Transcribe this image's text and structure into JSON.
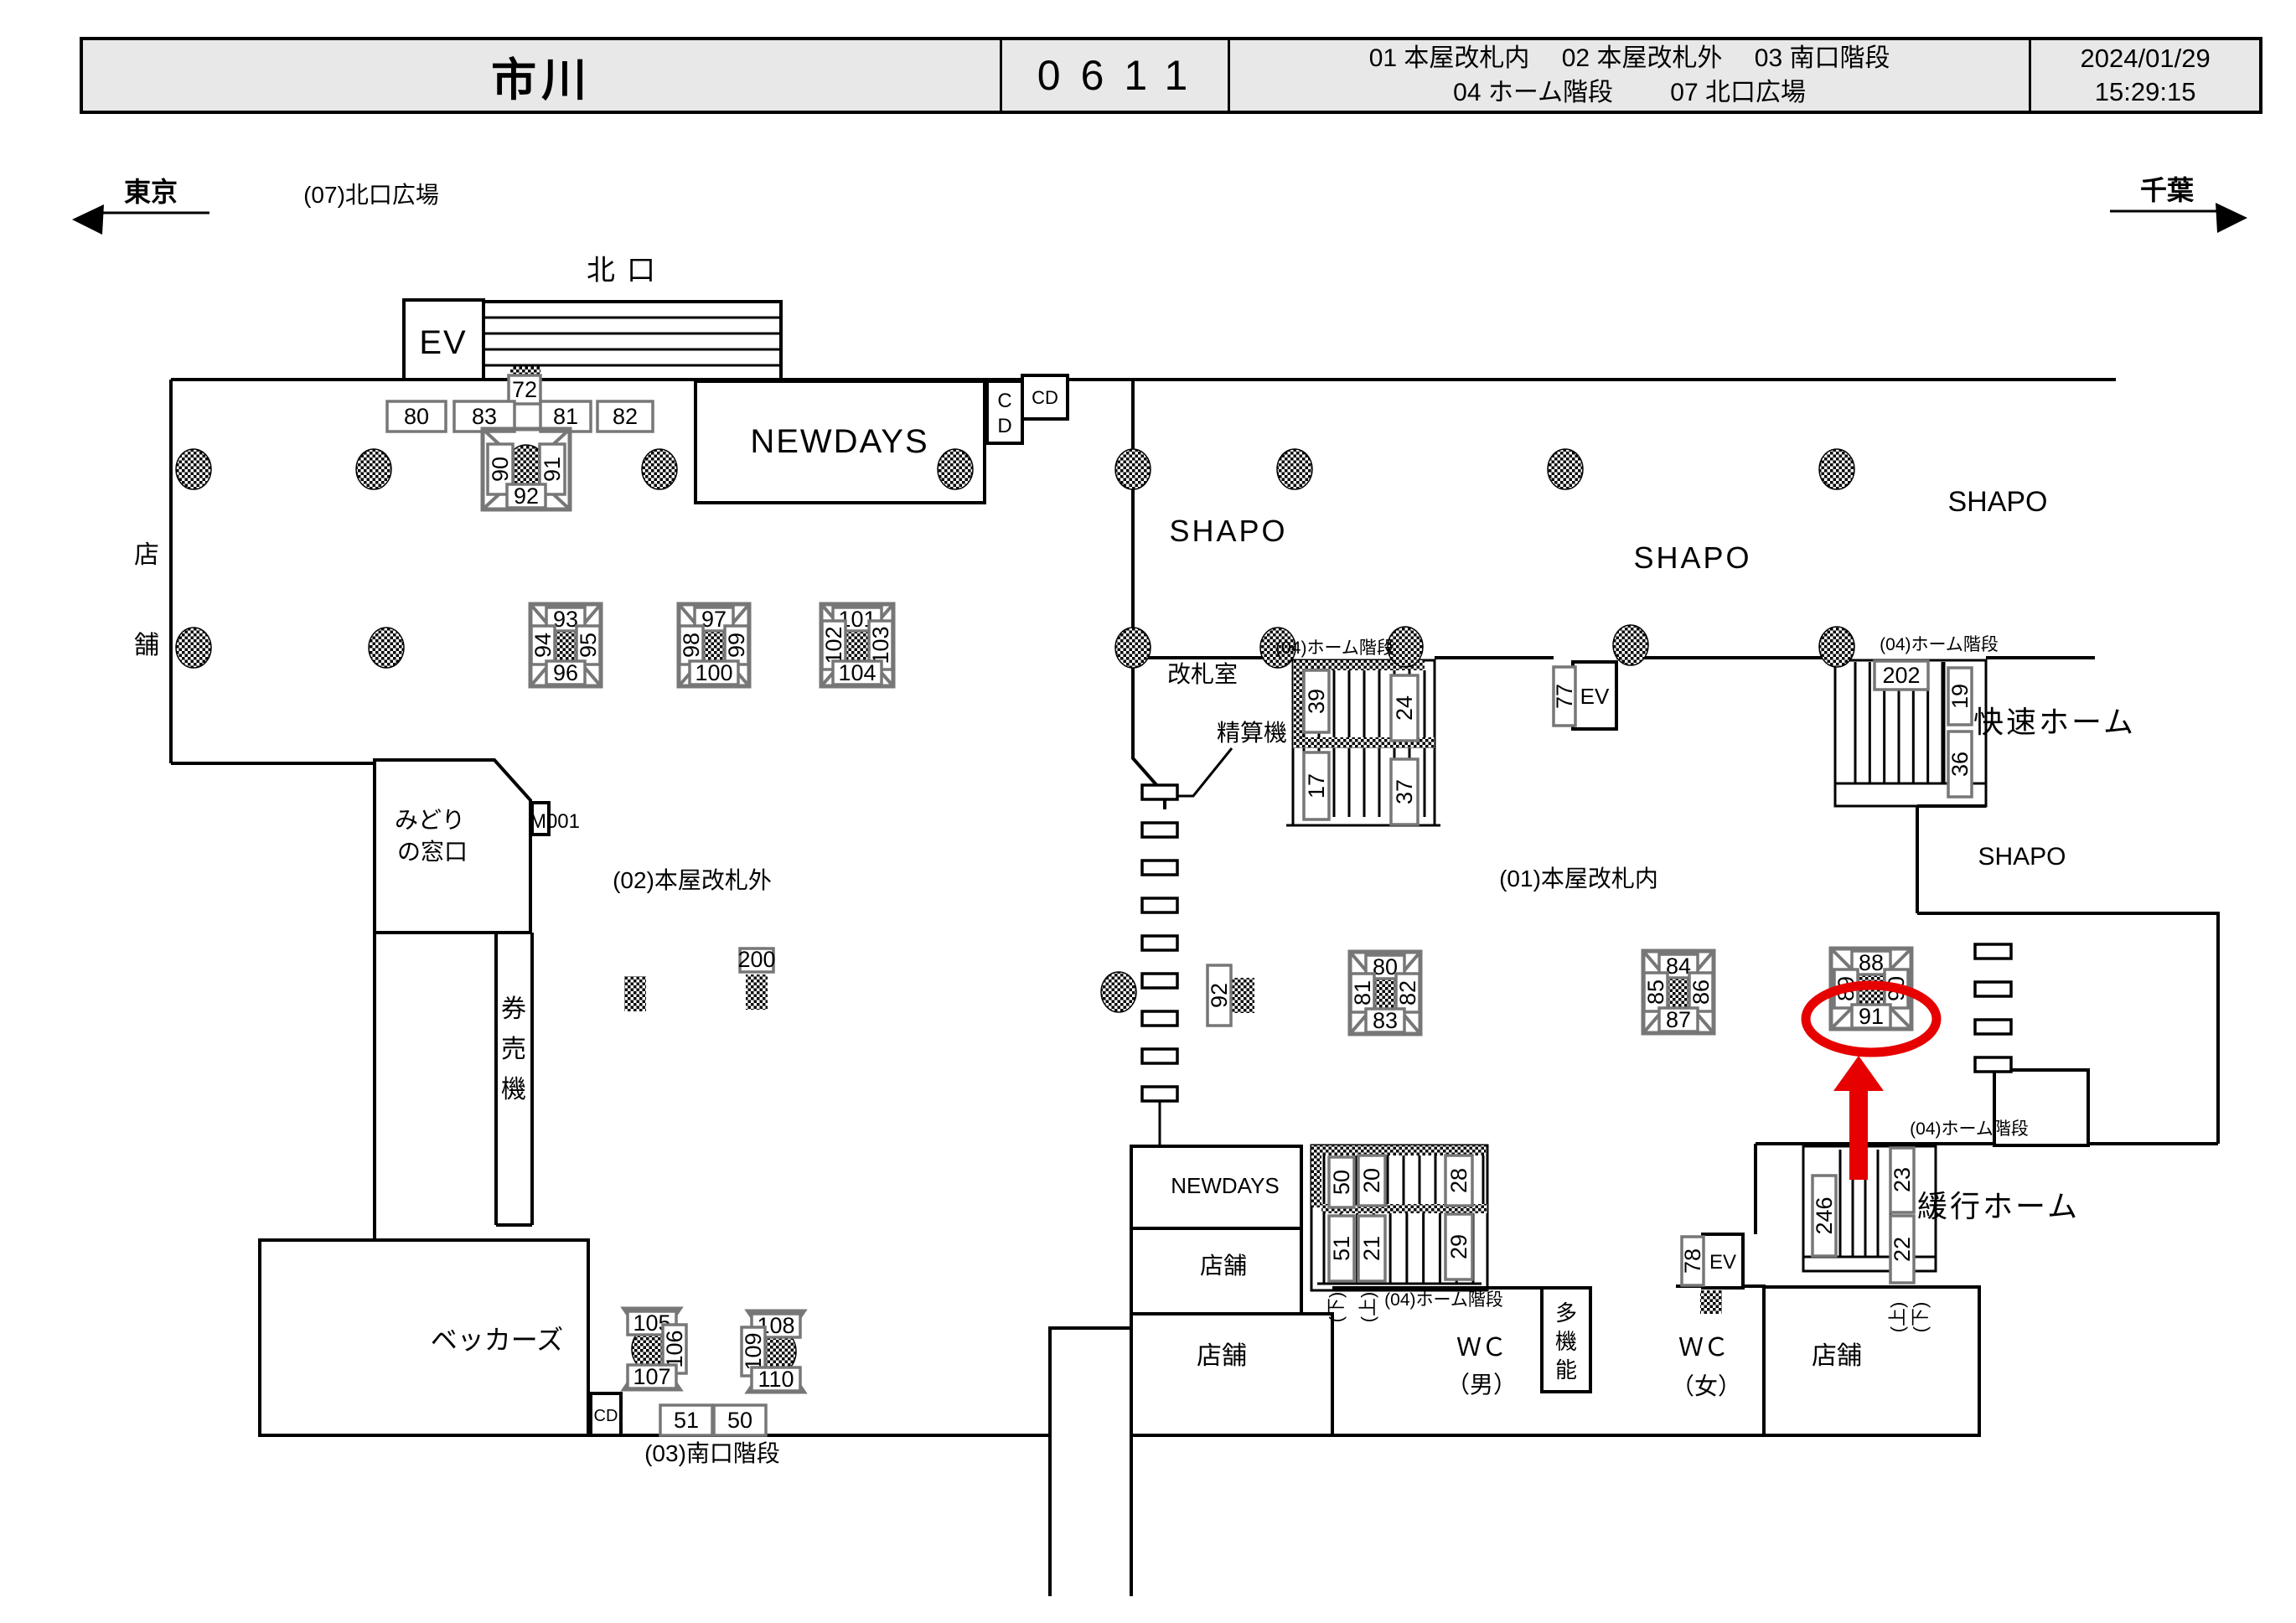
{
  "header": {
    "station_name": "市川",
    "station_code": "0611",
    "legend_line1": "01 本屋改札内　 02 本屋改札外　 03 南口階段",
    "legend_line2": "04 ホーム階段　　 07 北口広場",
    "date": "2024/01/29",
    "time": "15:29:15"
  },
  "directions": {
    "left_station": "東京",
    "right_station": "千葉"
  },
  "area_labels": {
    "north_plaza": "(07)北口広場",
    "north_gate": "北口",
    "ev_north": "EV",
    "ev_center": "EV",
    "ev_south": "EV",
    "newdays_top": "NEWDAYS",
    "newdays_bottom": "NEWDAYS",
    "cd_vert_c": "C",
    "cd_vert_d": "D",
    "cd_top": "CD",
    "cd_bottom": "CD",
    "shapo_1": "SHAPO",
    "shapo_2": "SHAPO",
    "shapo_3": "SHAPO",
    "shapo_4": "SHAPO",
    "gate_office": "改札室",
    "fare_adjust": "精算機",
    "platform_stairs_1": "(04)ホーム階段",
    "platform_stairs_2": "(04)ホーム階段",
    "platform_stairs_3": "(04)ホーム階段",
    "platform_stairs_4": "(04)ホーム階段",
    "rapid_platform": "快速ホーム",
    "local_platform": "緩行ホーム",
    "outside_gates": "(02)本屋改札外",
    "inside_gates": "(01)本屋改札内",
    "south_stairs": "(03)南口階段",
    "midori_line1": "みどり",
    "midori_line2": "の窓口",
    "m001": "M001",
    "kenbaiki_1": "券",
    "kenbaiki_2": "売",
    "kenbaiki_3": "機",
    "shop_left_1": "店",
    "shop_left_2": "舗",
    "beckers": "ベッカーズ",
    "shop_c1": "店舗",
    "shop_c2": "店舗",
    "shop_br": "店舗",
    "wc_m_1": "ＷＣ",
    "wc_m_2": "（男）",
    "wc_f_1": "ＷＣ",
    "wc_f_2": "（女）",
    "multi_1": "多",
    "multi_2": "機",
    "multi_3": "能",
    "down_center": "(下)",
    "up_center": "(上)",
    "up_right": "(上)",
    "down_right": "(下)"
  },
  "camera_boxes": {
    "c72": "72",
    "c80": "80",
    "c83": "83",
    "c81": "81",
    "c82": "82",
    "c200": "200",
    "c92gate": "92",
    "c77": "77",
    "c39": "39",
    "c24": "24",
    "c17": "17",
    "c37": "37",
    "c202": "202",
    "c19": "19",
    "c36": "36",
    "c50t": "50",
    "c20": "20",
    "c28": "28",
    "c51t": "51",
    "c21": "21",
    "c29": "29",
    "c246": "246",
    "c23": "23",
    "c22": "22",
    "c78": "78",
    "c51b": "51",
    "c50b": "50"
  },
  "clusters": [
    {
      "left": "90",
      "right": "91",
      "bottom": "92"
    },
    {
      "top": "93",
      "left": "94",
      "right": "95",
      "bottom": "96"
    },
    {
      "top": "97",
      "left": "98",
      "right": "99",
      "bottom": "100"
    },
    {
      "top": "101",
      "left": "102",
      "right": "103",
      "bottom": "104"
    },
    {
      "top": "80",
      "left": "81",
      "right": "82",
      "bottom": "83"
    },
    {
      "top": "84",
      "left": "85",
      "right": "86",
      "bottom": "87"
    },
    {
      "top": "88",
      "left": "89",
      "right": "90",
      "bottom": "91"
    },
    {
      "top": "105",
      "right": "106",
      "bottom": "107"
    },
    {
      "top": "108",
      "left": "109",
      "bottom": "110"
    }
  ],
  "highlight": {
    "target_camera": "91",
    "color": "#e60000"
  }
}
